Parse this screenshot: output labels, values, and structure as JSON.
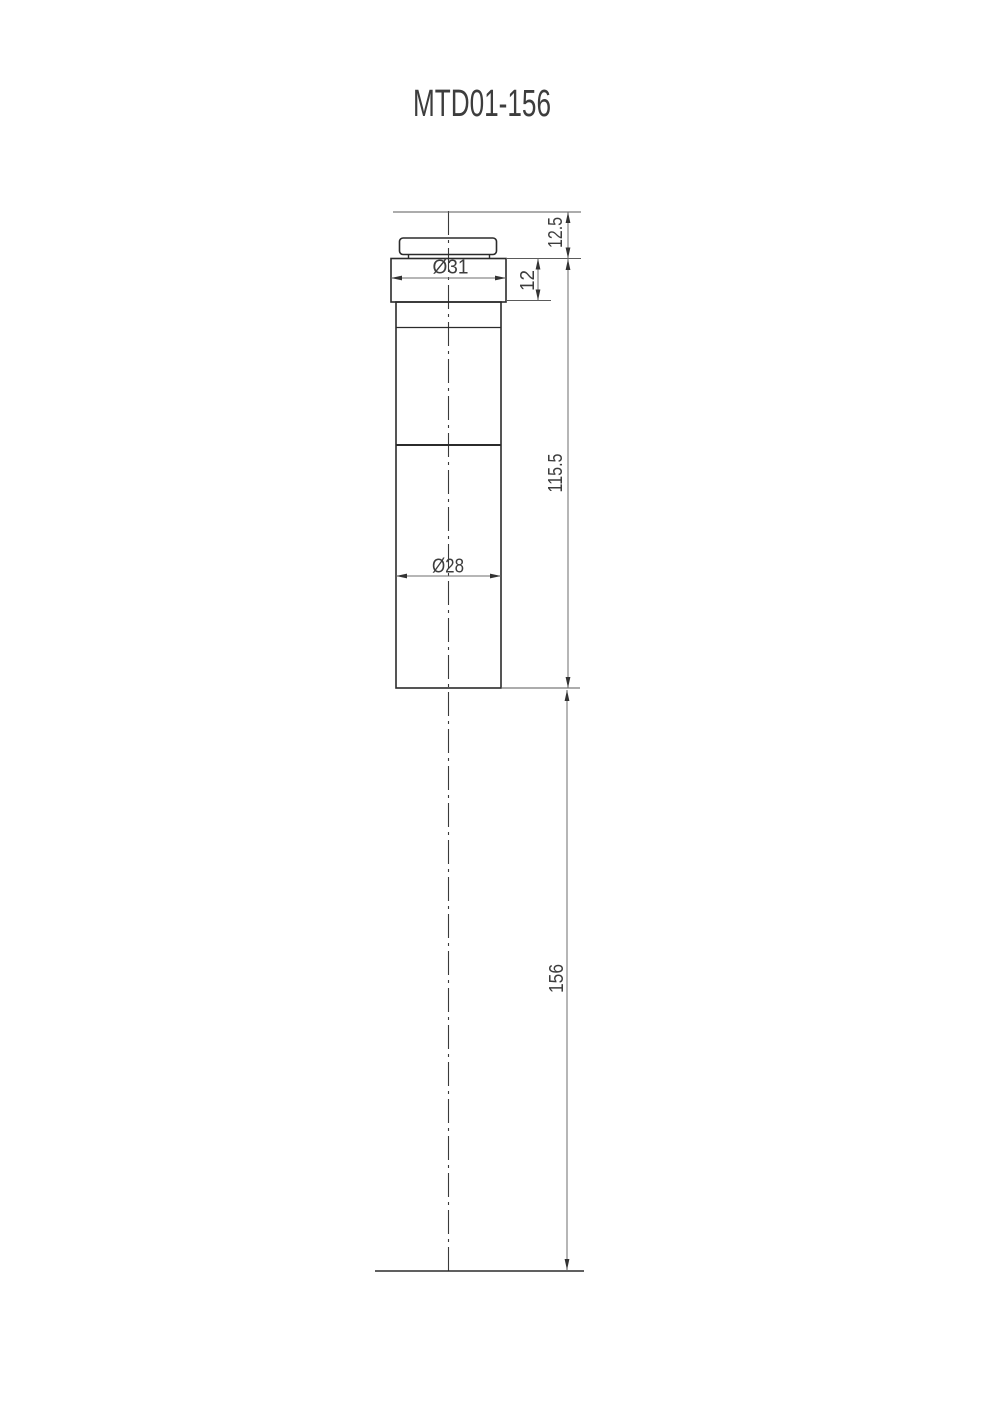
{
  "title": "MTD01-156",
  "drawing": {
    "dimensions": {
      "flange_diameter": "Ø31",
      "body_diameter": "Ø28",
      "top_offset": "12.5",
      "flange_height": "12",
      "body_length": "115.5",
      "overall_rod_length": "156"
    }
  },
  "colors": {
    "background": "#ffffff",
    "part_line": "#2b2b2b",
    "dimension_line": "#6e6e6e",
    "text": "#3d3d3d"
  }
}
